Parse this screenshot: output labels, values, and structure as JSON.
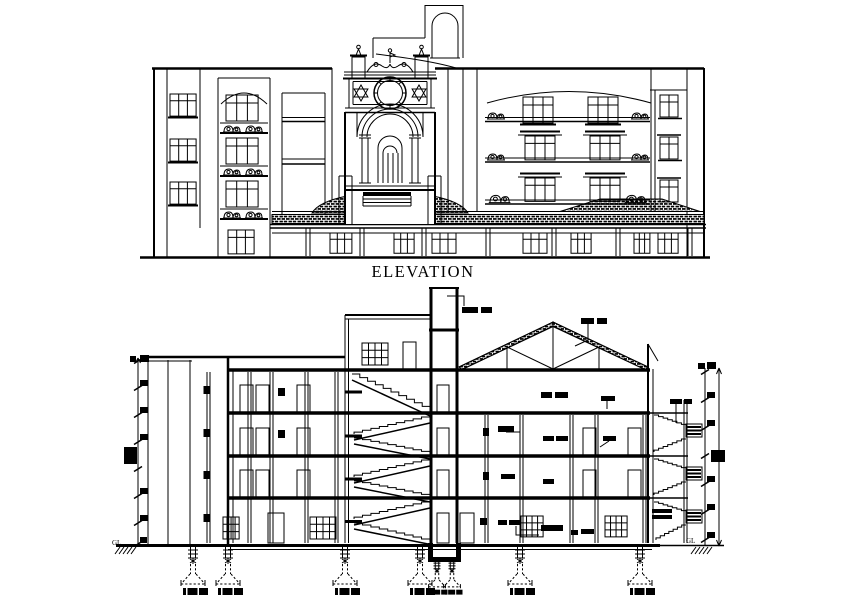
{
  "page": {
    "background": "#ffffff",
    "ink": "#000000"
  },
  "elevation": {
    "caption": "ELEVATION"
  },
  "section": {
    "gl_left": "GL",
    "gl_right": "GL"
  }
}
